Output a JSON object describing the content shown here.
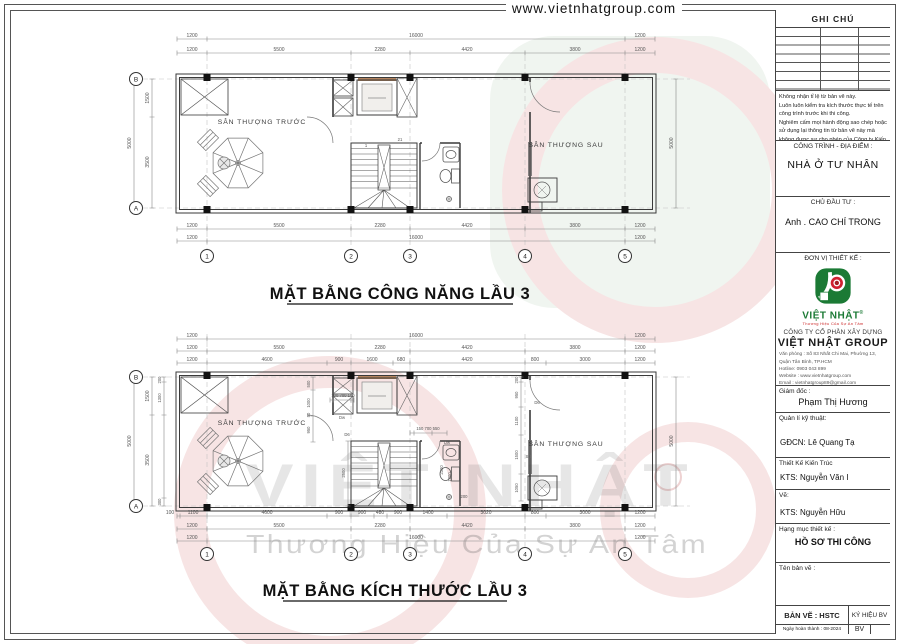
{
  "header": {
    "url": "www.vietnhatgroup.com"
  },
  "watermark": {
    "brand": "VIỆT NHẬT",
    "tagline": "Thương Hiệu Của Sự An Tâm"
  },
  "grid": {
    "cols": [
      "1",
      "2",
      "3",
      "4",
      "5"
    ],
    "row_top": "B",
    "row_bottom": "A"
  },
  "plan1": {
    "title": "MẶT BẰNG CÔNG NĂNG LẦU 3",
    "room_front": "SÂN THƯỢNG TRƯỚC",
    "room_rear": "SÂN THƯỢNG SAU",
    "stair_first": "1",
    "stair_last": "21",
    "dims_top_row1": [
      "1200",
      "16000",
      "1200"
    ],
    "dims_top_row2": [
      "1200",
      "5500",
      "2280",
      "4420",
      "3800",
      "1200"
    ],
    "dims_bottom_row1": [
      "1200",
      "5500",
      "2280",
      "4420",
      "3800",
      "1200"
    ],
    "dims_bottom_row2": [
      "1200",
      "16000",
      "1200"
    ],
    "dims_left": {
      "seg1": "1500",
      "seg2": "3500",
      "total": "5000"
    },
    "dims_right": {
      "total": "5000"
    }
  },
  "plan2": {
    "title": "MẶT BẰNG KÍCH THƯỚC LẦU 3",
    "room_front": "SÂN THƯỢNG TRƯỚC",
    "room_rear": "SÂN THƯỢNG SAU",
    "dims_top_row1": [
      "1200",
      "16000",
      "1200"
    ],
    "dims_top_row2": [
      "1200",
      "5500",
      "2280",
      "4420",
      "3800",
      "1200"
    ],
    "dims_top_row3": [
      "1200",
      "4600",
      "900",
      "1600",
      "680",
      "4420",
      "800",
      "3000",
      "1200"
    ],
    "dims_bottom_row1": [
      "100",
      "1100",
      "4600",
      "900",
      "900",
      "480",
      "900",
      "1400",
      "3020",
      "800",
      "3000",
      "1200"
    ],
    "dims_bottom_row2": [
      "1200",
      "5500",
      "2280",
      "4420",
      "3800",
      "1200"
    ],
    "dims_bottom_row3": [
      "1200",
      "16000",
      "1200"
    ],
    "dims_left": {
      "seg1": "1500",
      "seg2": "3500",
      "total": "5000",
      "wall": "200",
      "split": "1300",
      "bottom": "300"
    },
    "dims_right": {
      "total": "5000"
    },
    "interior": {
      "lobby_stack": [
        "500",
        "1000",
        "50",
        "950"
      ],
      "shaft_dims": "100 700 100",
      "door_dw": "Dw",
      "door_d6": "D6",
      "bath_strip": "150 700 550",
      "bath_door": "Dw",
      "stair_width": "2500",
      "bath_depth": "2300",
      "bath_len": "1200",
      "bath_off": "200",
      "right_stack": [
        "200",
        "950",
        "1100",
        "1500",
        "1050"
      ],
      "right_door": "D6",
      "right_window": "S8"
    }
  },
  "titleblock": {
    "ghi_chu": "GHI CHÚ",
    "notes": [
      "Không nhận tỉ lệ từ bản vẽ này.",
      "Luôn luôn kiểm tra kích thước thực tế trên công trình trước khi thi công.",
      "Nghiêm cấm mọi hành động sao chép hoặc sử dụng lại thông tin từ bản vẽ này mà không được sự cho phép của Công ty Kiến Trúc Việt Quang."
    ],
    "cong_trinh_label": "CÔNG TRÌNH - ĐỊA ĐIỂM :",
    "cong_trinh_value": "NHÀ Ở TƯ NHÂN",
    "chu_dau_tu_label": "CHỦ ĐẦU TƯ :",
    "chu_dau_tu_value": "Anh . CAO CHÍ TRONG",
    "don_vi_label": "ĐƠN VỊ THIẾT KẾ :",
    "logo_brand": "VIỆT NHẬT",
    "logo_reg": "®",
    "logo_tagline": "Thương Hiệu Của Sự An Tâm",
    "company_type": "CÔNG TY CỔ PHẦN XÂY DỰNG",
    "company_name": "VIỆT NHẬT GROUP",
    "contact": [
      "Văn phòng : Số 83 Nhất Chi Mai, Phường 13, Quận Tân Bình, TP.HCM",
      "Hotline: 0903 043 899",
      "Website : www.vietnhatgroup.com",
      "Email : vietnhatgroup89@gmail.com",
      "MST : 0316998592"
    ],
    "giam_doc_label": "Giám đốc :",
    "giam_doc_value": "Phạm Thị Hương",
    "qlkt_label": "Quản lí kỹ thuật:",
    "qlkt_value": "GĐCN: Lê Quang Tạ",
    "tkkt_label": "Thiết Kế Kiến Trúc",
    "tkkt_value": "KTS: Nguyễn Văn I",
    "ve_label": "Vẽ:",
    "ve_value": "KTS: Nguyễn Hữu",
    "hang_muc_label": "Hạng mục thiết kế :",
    "hang_muc_value": "HỒ SƠ THI CÔNG",
    "ten_ban_ve_label": "Tên bản vẽ :",
    "ban_ve": "BẢN VẼ : HSTC",
    "ky_hieu": "KÝ HIỆU BV",
    "ngay": "Ngày hoàn thành :  08-2024",
    "bv": "BV"
  }
}
